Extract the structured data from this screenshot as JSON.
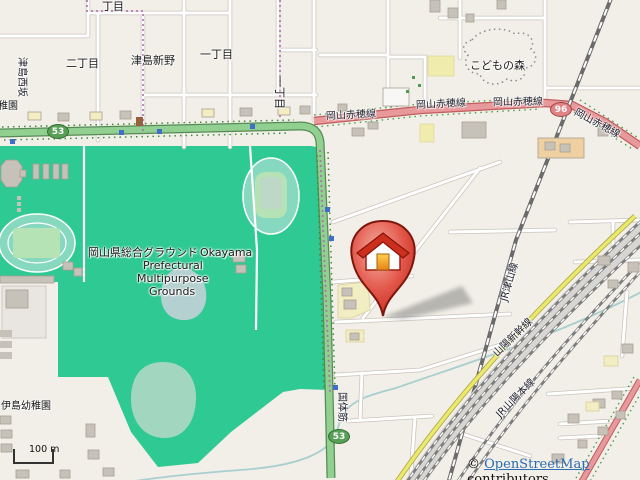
{
  "map": {
    "title": "OpenStreetMap view with house location marker",
    "labels": {
      "chome_top": "丁目",
      "nichome": "二丁目",
      "tsushima_shinno": "津島新野",
      "itchome": "一丁目",
      "itchome_east": "一丁目",
      "kodomo_no_mori": "こどもの森",
      "okayama_ako_line": "岡山赤穂線",
      "kokutai_suji": "国体筋",
      "jr_tsuyama_line": "JR津山線",
      "sanyo_shinkansen": "山陽新幹線",
      "jr_sanyo_main_line": "JR山陽本線",
      "park_name_ja": "岡山県総合グラウンド",
      "park_name_en_1": "Okayama",
      "park_name_en_2": "Prefectural",
      "park_name_en_3": "Multipurpose",
      "park_name_en_4": "Grounds",
      "ijima_kindergarten": "伊島幼稚園",
      "kindergarten_partial": "稚園",
      "west_street": "津島西坂"
    },
    "route_shields": {
      "national_53": "53",
      "prefectural_96": "96"
    },
    "scale_bar": {
      "label": "100 m"
    },
    "attribution": {
      "copyright": "© ",
      "link_text": "OpenStreetMap",
      "suffix": " contributors"
    },
    "marker": {
      "type": "house-pin"
    },
    "colors": {
      "background": "#f2efe8",
      "sports_grounds_green": "#2fc993",
      "track_ring": "#86d9be",
      "field_green": "#b5e3b5",
      "pond_blue": "#b5d0d0",
      "trunk_road": "#92d092",
      "primary_road": "#e8999b",
      "secondary_road": "#ebe86e",
      "railway_gray": "#7d7d7d",
      "boundary_purple": "#ad64ad",
      "building_gray": "#c6c1b9",
      "marker_red": "#c22718"
    }
  }
}
